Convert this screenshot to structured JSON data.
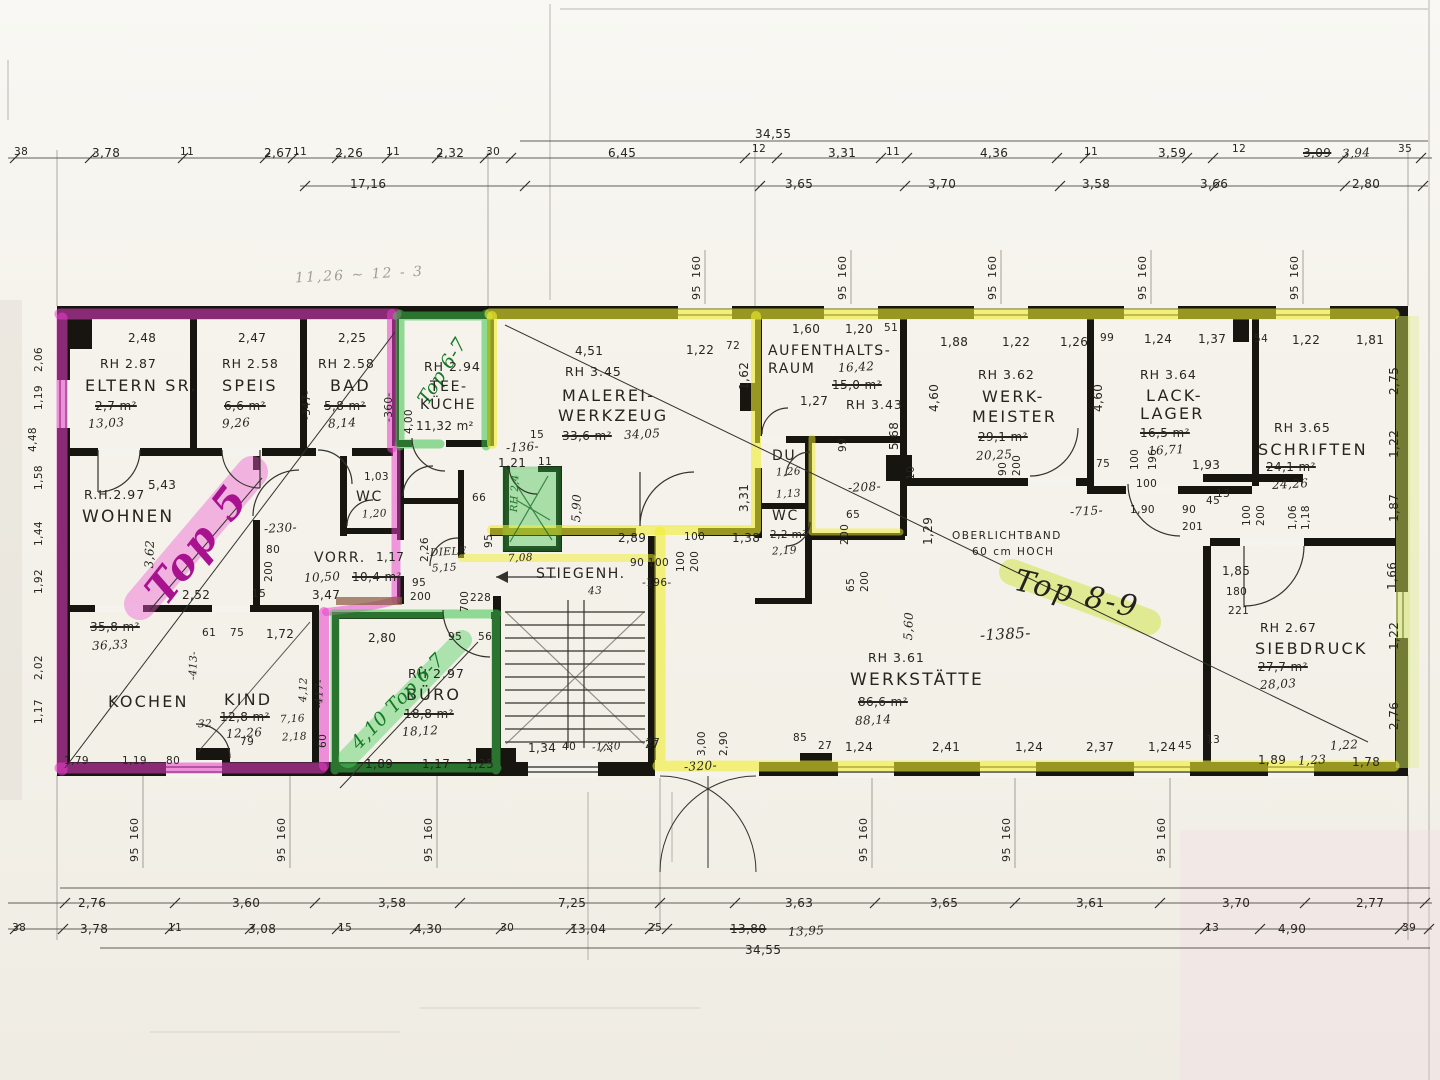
{
  "meta": {
    "kind": "scanned architectural floor plan with highlighter markup"
  },
  "colors": {
    "pink_marker": "#e23cc8",
    "green_marker": "#3cc24a",
    "yellow_marker": "#f0ee2e",
    "lime_band": "#cde45a",
    "wall_ink": "#16150f"
  },
  "annotations": {
    "top5": "Top 5",
    "top67": "Top 6-7",
    "top67b": "4,10 Top 6-7",
    "top89": "Top 8-9",
    "note": "11,26 ~ 12 - 3"
  },
  "chains": {
    "t_overall": "34,55",
    "t1": [
      "38",
      "3,78",
      "11",
      "2,67",
      "11",
      "2,26",
      "11",
      "2,32",
      "30",
      "6,45",
      "12",
      "3,31",
      "11",
      "4,36",
      "11",
      "3,59",
      "12",
      "3,09",
      "3,94",
      "35"
    ],
    "t2": [
      "17,16",
      "3,65",
      "3,70",
      "3,58",
      "3,66",
      "2,80"
    ],
    "b1": [
      "2,76",
      "3,60",
      "3,58",
      "7,25",
      "3,63",
      "3,65",
      "3,61",
      "3,70",
      "2,77"
    ],
    "b2": [
      "38",
      "3,78",
      "11",
      "3,08",
      "15",
      "4,30",
      "30",
      "13,04",
      "25",
      "13,80",
      "13,95",
      "13",
      "4,90",
      "39"
    ],
    "b_overall": "34,55",
    "win_a": "95",
    "win_b": "160"
  },
  "rooms": {
    "eltern": {
      "rh": "RH 2.87",
      "name": "ELTERN SR.",
      "old": "2,7 m²",
      "hand": "13,03"
    },
    "speis": {
      "rh": "RH 2.58",
      "name": "SPEIS",
      "old": "6,6 m²",
      "hand": "9,26"
    },
    "bad": {
      "rh": "RH 2.58",
      "name": "BAD",
      "old": "5,8 m²",
      "hand": "8,14"
    },
    "teek": {
      "rh": "RH 2.94",
      "name1": "TEE-",
      "name2": "KÜCHE",
      "area": "11,32 m²"
    },
    "malerei": {
      "rh": "RH 3.45",
      "name1": "MALEREI-",
      "name2": "WERKZEUG",
      "old": "33,6 m²",
      "hand": "34,05"
    },
    "aufenthalt": {
      "rh": "RH 3.43",
      "name1": "AUFENTHALTS-",
      "name2": "RAUM",
      "old": "15,0 m²",
      "hand": "16,42"
    },
    "du": {
      "name": "DU",
      "hand": "1,26"
    },
    "wc_mid": {
      "name": "WC",
      "old": "2,2 m²",
      "hand": "2,19",
      "extra": "1,13"
    },
    "werkmeister": {
      "rh": "RH 3.62",
      "name1": "WERK-",
      "name2": "MEISTER",
      "old": "29,1 m²",
      "hand": "20,25"
    },
    "lacklager": {
      "rh": "RH 3.64",
      "name1": "LACK-",
      "name2": "LAGER",
      "old": "16,5 m²",
      "hand": "16,71"
    },
    "schriften": {
      "rh": "RH 3.65",
      "name": "SCHRIFTEN",
      "old": "24,1 m²",
      "hand": "24,26"
    },
    "wohnen": {
      "rh": "R.H.2.97",
      "name": "WOHNEN",
      "old": "35,8 m²",
      "hand": "36,33"
    },
    "kochen": {
      "name": "KOCHEN"
    },
    "kind": {
      "name": "KIND",
      "old": "12,8 m²",
      "hand": "12,26"
    },
    "buero": {
      "rh": "RH 2.97",
      "name": "BÜRO",
      "old": "18,8 m²",
      "hand": "18,12"
    },
    "vorr": {
      "name": "VORR.",
      "old": "10,4 m²",
      "hand": "10,50"
    },
    "wc_left": {
      "name": "WC"
    },
    "diele": {
      "name": "DIELE",
      "hand": "5,15"
    },
    "stiegen": {
      "name": "STIEGENH."
    },
    "werkstaette": {
      "rh": "RH 3.61",
      "name": "WERKSTÄTTE",
      "old": "86,6 m²",
      "hand": "88,14"
    },
    "siebdruck": {
      "rh": "RH 2.67",
      "name": "SIEBDRUCK",
      "old": "27,7 m²",
      "hand": "28,03"
    },
    "oberlicht": {
      "line1": "OBERLICHTBAND",
      "line2": "60 cm HOCH"
    },
    "closet": {
      "rh": "RH 2,4"
    }
  },
  "d": {
    "eltern_w": "2,48",
    "speis_w": "2,47",
    "bad_w": "2,25",
    "r347": "-347-",
    "r360": "-360-",
    "teek_h": "4,00",
    "mal_w": "4,51",
    "mal_122": "1,22",
    "mal_72": "72",
    "mal_162": "1,62",
    "mal_15": "15",
    "mal_136": "-136-",
    "mal_121": "1,21",
    "mal_11": "11",
    "mal_590": "5,90",
    "mal_331": "3,31",
    "mal_289": "2,89",
    "mal_100": "100",
    "mal_138": "1,38",
    "auf_160": "1,60",
    "auf_120": "1,20",
    "auf_51": "51",
    "auf_127": "1,27",
    "wm_188": "1,88",
    "wm_122": "1,22",
    "wm_126": "1,26",
    "wm_460": "4,60",
    "wm_90": "90",
    "wm_200": "200",
    "wm_10": "10",
    "mid_99": "99",
    "mid_208": "-208-",
    "mid_65": "65",
    "mid_200": "200",
    "mid_568": "5,68",
    "mid_129": "1,29",
    "mid_715": "-715-",
    "lk_99": "99",
    "lk_124": "1,24",
    "lk_137": "1,37",
    "lk_460": "4,60",
    "lk_75": "75",
    "lk_100": "100",
    "lk_196": "196",
    "lk_193": "1,93",
    "lk_100b": "100",
    "lk_190": "1,90",
    "lk_90": "90",
    "lk_201": "201",
    "lk_45": "45",
    "sch_54": "54",
    "sch_122": "1,22",
    "sch_181": "1,81",
    "sch_13": "13",
    "sch_100": "100",
    "sch_200": "200",
    "sch_106": "1,06",
    "sch_118": "1,18",
    "redge": [
      "2,75",
      "1,22",
      "1,87",
      "1,66",
      "1,22",
      "2,76"
    ],
    "sie_185": "1,85",
    "sie_180": "180",
    "sie_221": "221",
    "ws_560": "5,60",
    "ws_65": "65",
    "ws_200": "200",
    "ws_1385": "-1385-",
    "wsb": [
      "27",
      "85",
      "27",
      "1,24",
      "2,41",
      "1,24",
      "2,37",
      "1,24",
      "45",
      "13",
      "1,89",
      "1,23",
      "1,78",
      "1,22"
    ],
    "door_300": "3,00",
    "door_290": "2,90",
    "door_320": "-320-",
    "kb": [
      "1,79",
      "1,19",
      "80"
    ],
    "wo_543": "5,43",
    "wo_252": "2,52",
    "wo_230": "-230-",
    "wo_80": "80",
    "wo_200": "200",
    "wo_15": "15",
    "wo_347": "3,47",
    "wo_362": "3,62",
    "ki_61": "61",
    "ki_75": "75",
    "ki_172": "1,72",
    "ki_413": "-413-",
    "ki_412": "4,12",
    "ki_417": "-417-",
    "ki_32": "32",
    "ki_79": "79",
    "ki_716": "7,16",
    "ki_218": "2,18",
    "ki_60": "60",
    "bu_280": "2,80",
    "bu_95": "95",
    "bu_56": "56",
    "bu_189": "1,89",
    "bu_117": "1,17",
    "bu_125": "1,25",
    "vo_117": "1,17",
    "wcl_103": "1,03",
    "wcl_120": "1,20",
    "di_226": "2,26",
    "di_66": "66",
    "di_95": "95",
    "di_95b": "95",
    "di_200": "200",
    "di_700": "700",
    "di_228": "228",
    "st_90100": "90 100",
    "st_196": "-196-",
    "st_100": "100",
    "st_200": "200",
    "st_134": "1,34",
    "st_40": "40",
    "st_130": "-1,30",
    "st_27": "27",
    "st_708": "7,08",
    "st_43": "43",
    "le": [
      "2,06",
      "1,19",
      "4,48",
      "1,58",
      "1,44",
      "1,92",
      "2,02",
      "1,17"
    ]
  }
}
